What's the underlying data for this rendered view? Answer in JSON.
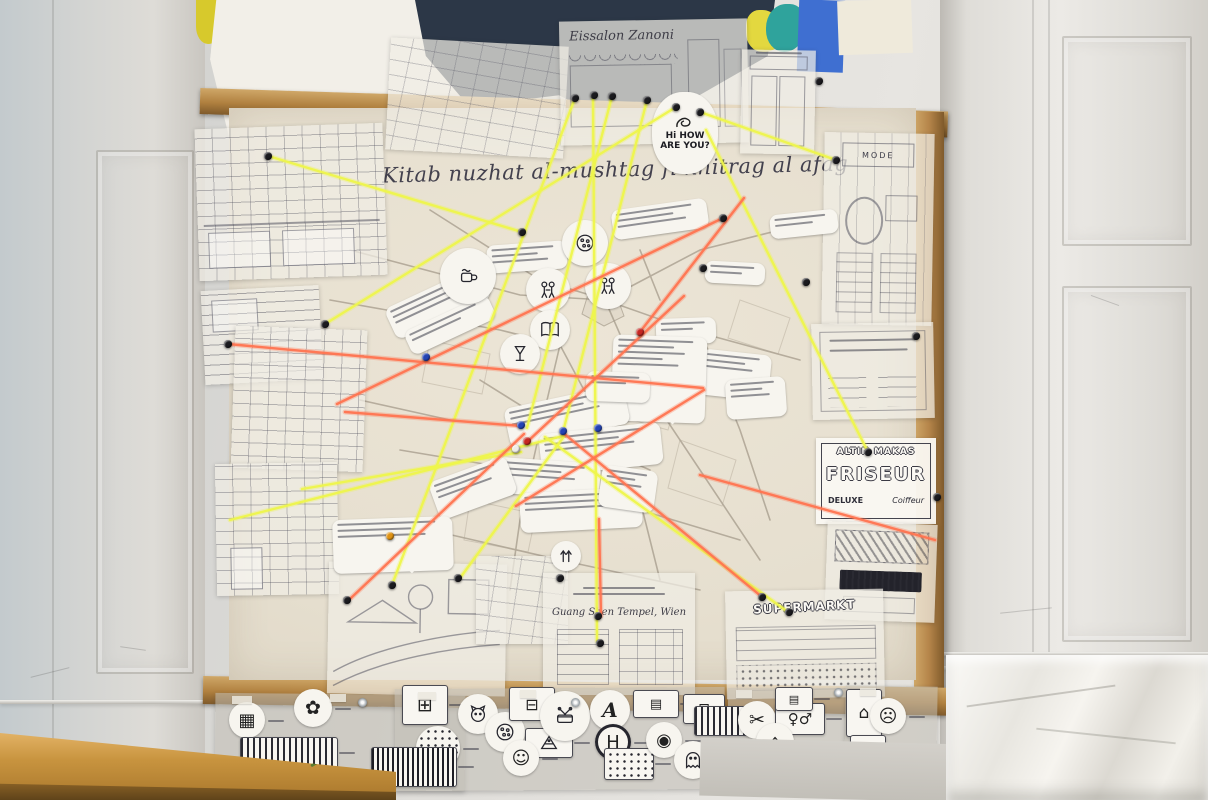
{
  "texts": {
    "map_title": "Kitab nuzhat al-mushtag fi khitrag al afag",
    "how_are_you_1": "Hi HOW",
    "how_are_you_2": "ARE YOU?",
    "eissalon_sign": "Eissalon Zanoni",
    "mode_sign": "MODE",
    "friseur_line1": "ALTIN MAKAS",
    "friseur_line2": "FRISEUR",
    "friseur_line3": "DELUXE",
    "friseur_line4": "Coiffeur",
    "tempel_sign": "Guang Shen Tempel, Wien",
    "supermarkt_sign": "SUPERMARKT"
  },
  "colors": {
    "string_yellow": "#eef64b",
    "string_orange": "#ff7450",
    "pin_black": "#1b1b1f",
    "pin_blue": "#2343b4",
    "pin_red": "#c62722",
    "pin_orange": "#e09312",
    "pin_white": "#efede6",
    "frame_wood": "#b5854a",
    "board_paper": "#e8e1d2",
    "artwork_navy": "#2c3747",
    "artwork_blue": "#3f6fd1",
    "artwork_teal": "#2fa39c",
    "artwork_yellow": "#e3d83f",
    "artwork_purple": "#7c3353",
    "table_wood": "#c8943f"
  },
  "strings": [
    {
      "c": "string_yellow",
      "p": [
        268,
        156,
        522,
        232
      ]
    },
    {
      "c": "string_yellow",
      "p": [
        575,
        98,
        392,
        585
      ]
    },
    {
      "c": "string_yellow",
      "p": [
        593,
        95,
        597,
        641
      ]
    },
    {
      "c": "string_yellow",
      "p": [
        612,
        96,
        527,
        428
      ]
    },
    {
      "c": "string_yellow",
      "p": [
        647,
        100,
        563,
        432
      ]
    },
    {
      "c": "string_yellow",
      "p": [
        676,
        107,
        325,
        324
      ]
    },
    {
      "c": "string_yellow",
      "p": [
        700,
        112,
        836,
        160
      ]
    },
    {
      "c": "string_yellow",
      "p": [
        706,
        130,
        868,
        452
      ]
    },
    {
      "c": "string_yellow",
      "p": [
        230,
        520,
        563,
        436
      ]
    },
    {
      "c": "string_yellow",
      "p": [
        302,
        489,
        521,
        452
      ]
    },
    {
      "c": "string_yellow",
      "p": [
        545,
        437,
        788,
        612
      ]
    },
    {
      "c": "string_yellow",
      "p": [
        565,
        435,
        460,
        578
      ]
    },
    {
      "c": "string_orange",
      "p": [
        337,
        404,
        723,
        218
      ]
    },
    {
      "c": "string_orange",
      "p": [
        228,
        344,
        703,
        388
      ]
    },
    {
      "c": "string_orange",
      "p": [
        345,
        412,
        521,
        426
      ]
    },
    {
      "c": "string_orange",
      "p": [
        351,
        598,
        524,
        434
      ]
    },
    {
      "c": "string_orange",
      "p": [
        562,
        432,
        762,
        597
      ]
    },
    {
      "c": "string_orange",
      "p": [
        599,
        519,
        601,
        616
      ]
    },
    {
      "c": "string_orange",
      "p": [
        684,
        296,
        527,
        442
      ]
    },
    {
      "c": "string_orange",
      "p": [
        744,
        198,
        640,
        332
      ]
    },
    {
      "c": "string_orange",
      "p": [
        704,
        390,
        516,
        506
      ]
    },
    {
      "c": "string_orange",
      "p": [
        700,
        475,
        935,
        540
      ]
    }
  ],
  "pins": [
    {
      "c": "pin_black",
      "x": 268,
      "y": 156
    },
    {
      "c": "pin_black",
      "x": 522,
      "y": 232
    },
    {
      "c": "pin_black",
      "x": 575,
      "y": 98
    },
    {
      "c": "pin_black",
      "x": 594,
      "y": 95
    },
    {
      "c": "pin_black",
      "x": 612,
      "y": 96
    },
    {
      "c": "pin_black",
      "x": 647,
      "y": 100
    },
    {
      "c": "pin_black",
      "x": 676,
      "y": 107
    },
    {
      "c": "pin_black",
      "x": 700,
      "y": 112
    },
    {
      "c": "pin_black",
      "x": 836,
      "y": 160
    },
    {
      "c": "pin_black",
      "x": 806,
      "y": 282
    },
    {
      "c": "pin_black",
      "x": 703,
      "y": 268
    },
    {
      "c": "pin_black",
      "x": 723,
      "y": 218
    },
    {
      "c": "pin_black",
      "x": 598,
      "y": 616
    },
    {
      "c": "pin_black",
      "x": 600,
      "y": 643
    },
    {
      "c": "pin_black",
      "x": 789,
      "y": 612
    },
    {
      "c": "pin_black",
      "x": 762,
      "y": 597
    },
    {
      "c": "pin_black",
      "x": 560,
      "y": 578
    },
    {
      "c": "pin_black",
      "x": 347,
      "y": 600
    },
    {
      "c": "pin_black",
      "x": 458,
      "y": 578
    },
    {
      "c": "pin_black",
      "x": 325,
      "y": 324
    },
    {
      "c": "pin_black",
      "x": 228,
      "y": 344
    },
    {
      "c": "pin_black",
      "x": 916,
      "y": 336
    },
    {
      "c": "pin_black",
      "x": 868,
      "y": 452
    },
    {
      "c": "pin_black",
      "x": 819,
      "y": 81
    },
    {
      "c": "pin_black",
      "x": 937,
      "y": 497
    },
    {
      "c": "pin_black",
      "x": 392,
      "y": 585
    },
    {
      "c": "pin_blue",
      "x": 521,
      "y": 425
    },
    {
      "c": "pin_blue",
      "x": 563,
      "y": 431
    },
    {
      "c": "pin_blue",
      "x": 598,
      "y": 428
    },
    {
      "c": "pin_blue",
      "x": 426,
      "y": 357
    },
    {
      "c": "pin_red",
      "x": 527,
      "y": 441
    },
    {
      "c": "pin_red",
      "x": 640,
      "y": 332
    },
    {
      "c": "pin_orange",
      "x": 390,
      "y": 536
    },
    {
      "c": "pin_white",
      "x": 516,
      "y": 449
    }
  ],
  "note_strips": [
    {
      "x": 386,
      "y": 286,
      "w": 104,
      "h": 34,
      "r": -25,
      "n": 3
    },
    {
      "x": 404,
      "y": 312,
      "w": 92,
      "h": 26,
      "r": -25,
      "n": 2
    },
    {
      "x": 487,
      "y": 243,
      "w": 80,
      "h": 28,
      "r": -4,
      "n": 3
    },
    {
      "x": 612,
      "y": 204,
      "w": 96,
      "h": 30,
      "r": -8,
      "n": 3
    },
    {
      "x": 770,
      "y": 212,
      "w": 68,
      "h": 24,
      "r": -6,
      "n": 2
    },
    {
      "x": 705,
      "y": 262,
      "w": 60,
      "h": 22,
      "r": 3,
      "n": 2
    },
    {
      "x": 656,
      "y": 318,
      "w": 60,
      "h": 26,
      "r": -2,
      "n": 2
    },
    {
      "x": 700,
      "y": 352,
      "w": 70,
      "h": 46,
      "r": 6,
      "n": 3,
      "tail": true
    },
    {
      "x": 612,
      "y": 336,
      "w": 94,
      "h": 86,
      "r": 2,
      "n": 5,
      "tail": true
    },
    {
      "x": 506,
      "y": 396,
      "w": 122,
      "h": 40,
      "r": -12,
      "n": 3
    },
    {
      "x": 540,
      "y": 428,
      "w": 122,
      "h": 42,
      "r": -6,
      "n": 3
    },
    {
      "x": 488,
      "y": 460,
      "w": 112,
      "h": 36,
      "r": 4,
      "n": 3
    },
    {
      "x": 520,
      "y": 490,
      "w": 122,
      "h": 40,
      "r": -3,
      "n": 3
    },
    {
      "x": 432,
      "y": 468,
      "w": 82,
      "h": 40,
      "r": -20,
      "n": 3
    },
    {
      "x": 586,
      "y": 372,
      "w": 64,
      "h": 30,
      "r": 2,
      "n": 2
    },
    {
      "x": 333,
      "y": 518,
      "w": 120,
      "h": 54,
      "r": -2,
      "n": 3,
      "tail": true
    },
    {
      "x": 600,
      "y": 468,
      "w": 56,
      "h": 42,
      "r": 8,
      "n": 3
    },
    {
      "x": 726,
      "y": 378,
      "w": 60,
      "h": 40,
      "r": -4,
      "n": 3
    }
  ],
  "map_stickers": [
    {
      "x": 548,
      "y": 290,
      "d": 44,
      "kind": "figures"
    },
    {
      "x": 608,
      "y": 286,
      "d": 46,
      "kind": "figures"
    },
    {
      "x": 585,
      "y": 243,
      "d": 46,
      "kind": "pizza"
    },
    {
      "x": 550,
      "y": 330,
      "d": 40,
      "kind": "book"
    },
    {
      "x": 520,
      "y": 354,
      "d": 40,
      "kind": "glass"
    },
    {
      "x": 468,
      "y": 276,
      "d": 56,
      "kind": "cup"
    },
    {
      "x": 566,
      "y": 556,
      "d": 30,
      "kind": "arrows"
    }
  ],
  "bottom_items": [
    {
      "x": 247,
      "y": 720,
      "d": 36,
      "glyph": "▦",
      "name": "building-icon"
    },
    {
      "x": 313,
      "y": 708,
      "d": 38,
      "glyph": "✿",
      "name": "flower-icon"
    },
    {
      "x": 288,
      "y": 752,
      "w": 96,
      "h": 30,
      "kind": "hatch",
      "name": "candy-wrapper-icon"
    },
    {
      "x": 424,
      "y": 704,
      "w": 44,
      "h": 38,
      "glyph": "⊞",
      "name": "box-icon"
    },
    {
      "x": 438,
      "y": 748,
      "d": 44,
      "kind": "dots",
      "name": "sprinkles-icon"
    },
    {
      "x": 413,
      "y": 766,
      "w": 84,
      "h": 38,
      "kind": "barcode",
      "name": "barcode-icon"
    },
    {
      "x": 478,
      "y": 714,
      "d": 40,
      "svg": "cat",
      "name": "cat-icon"
    },
    {
      "x": 505,
      "y": 732,
      "d": 40,
      "svg": "pizza",
      "name": "pizza-icon"
    },
    {
      "x": 531,
      "y": 703,
      "w": 44,
      "h": 32,
      "glyph": "⊟",
      "name": "coffee-machine-icon"
    },
    {
      "x": 548,
      "y": 742,
      "w": 46,
      "h": 28,
      "svg": "cake",
      "name": "cake-icon"
    },
    {
      "x": 521,
      "y": 758,
      "d": 36,
      "glyph": "☺",
      "name": "smiley-icon"
    },
    {
      "x": 565,
      "y": 716,
      "d": 50,
      "svg": "drum",
      "name": "drum-icon"
    },
    {
      "x": 610,
      "y": 710,
      "d": 40,
      "glyph": "A",
      "serif": true,
      "name": "letter-a-icon"
    },
    {
      "x": 613,
      "y": 742,
      "d": 36,
      "glyph": "H",
      "ring": true,
      "name": "station-sign-icon"
    },
    {
      "x": 655,
      "y": 703,
      "w": 44,
      "h": 26,
      "glyph": "▤",
      "name": "sign-icon"
    },
    {
      "x": 703,
      "y": 708,
      "w": 40,
      "h": 28,
      "glyph": "⊡",
      "name": "tv-icon"
    },
    {
      "x": 628,
      "y": 763,
      "w": 48,
      "h": 30,
      "kind": "dots",
      "name": "dotted-card-icon"
    },
    {
      "x": 664,
      "y": 740,
      "d": 36,
      "glyph": "◉",
      "name": "face-icon"
    },
    {
      "x": 693,
      "y": 760,
      "d": 38,
      "svg": "ghost",
      "name": "ghost-icon"
    },
    {
      "x": 722,
      "y": 720,
      "w": 56,
      "h": 28,
      "kind": "hatch",
      "name": "pastry-icon"
    },
    {
      "x": 757,
      "y": 720,
      "d": 38,
      "glyph": "✂",
      "name": "scissors-icon"
    },
    {
      "x": 799,
      "y": 718,
      "w": 48,
      "h": 30,
      "glyph": "♀♂",
      "name": "couple-icon"
    },
    {
      "x": 793,
      "y": 698,
      "w": 36,
      "h": 22,
      "glyph": "▤",
      "name": "shelf-icon"
    },
    {
      "x": 775,
      "y": 742,
      "d": 38,
      "glyph": "⌂",
      "name": "house-icon"
    },
    {
      "x": 748,
      "y": 760,
      "d": 40,
      "svg": "icecream",
      "name": "ice-cream-icon"
    },
    {
      "x": 803,
      "y": 760,
      "w": 52,
      "h": 26,
      "kind": "barcode",
      "name": "ticket-icon"
    },
    {
      "x": 863,
      "y": 712,
      "w": 34,
      "h": 46,
      "glyph": "⌂",
      "name": "tall-house-icon"
    },
    {
      "x": 888,
      "y": 716,
      "d": 36,
      "glyph": "☹",
      "name": "sad-face-icon"
    },
    {
      "x": 867,
      "y": 748,
      "w": 34,
      "h": 26,
      "glyph": "✡",
      "name": "synagogue-icon"
    }
  ],
  "tapes": [
    {
      "x": 232,
      "y": 696,
      "w": 20,
      "h": 8
    },
    {
      "x": 330,
      "y": 694,
      "w": 16,
      "h": 8
    },
    {
      "x": 418,
      "y": 692,
      "w": 18,
      "h": 8
    },
    {
      "x": 520,
      "y": 690,
      "w": 16,
      "h": 8
    },
    {
      "x": 736,
      "y": 690,
      "w": 16,
      "h": 8
    },
    {
      "x": 860,
      "y": 688,
      "w": 16,
      "h": 8
    },
    {
      "x": 1037,
      "y": 731,
      "w": 16,
      "h": 10
    }
  ],
  "screws": [
    {
      "x": 362,
      "y": 702
    },
    {
      "x": 575,
      "y": 702
    },
    {
      "x": 838,
      "y": 692
    }
  ]
}
